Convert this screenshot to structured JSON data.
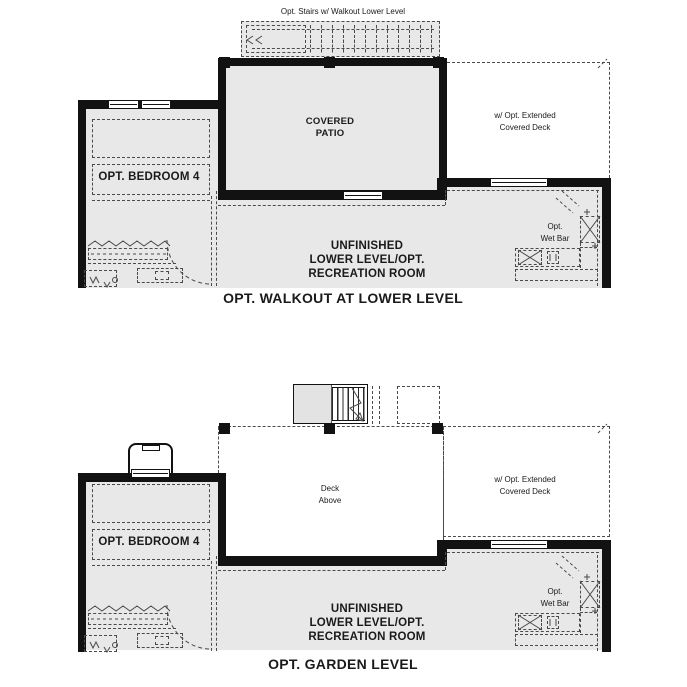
{
  "colors": {
    "fill": "#e8e8e8",
    "wall": "#121212",
    "line": "#4a4a4a"
  },
  "plan_walkout": {
    "stairs_label": "Opt. Stairs w/ Walkout Lower Level",
    "covered_patio": "COVERED\nPATIO",
    "extended_deck": "w/ Opt. Extended\nCovered Deck",
    "bedroom": "OPT. BEDROOM 4",
    "wet_bar": "Opt.\nWet Bar",
    "recreation": "UNFINISHED\nLOWER LEVEL/OPT.\nRECREATION ROOM",
    "caption": "OPT. WALKOUT AT LOWER LEVEL"
  },
  "plan_garden": {
    "deck_above": "Deck\nAbove",
    "extended_deck": "w/ Opt. Extended\nCovered Deck",
    "bedroom": "OPT. BEDROOM 4",
    "wet_bar": "Opt.\nWet Bar",
    "recreation": "UNFINISHED\nLOWER LEVEL/OPT.\nRECREATION ROOM",
    "caption": "OPT. GARDEN LEVEL"
  }
}
